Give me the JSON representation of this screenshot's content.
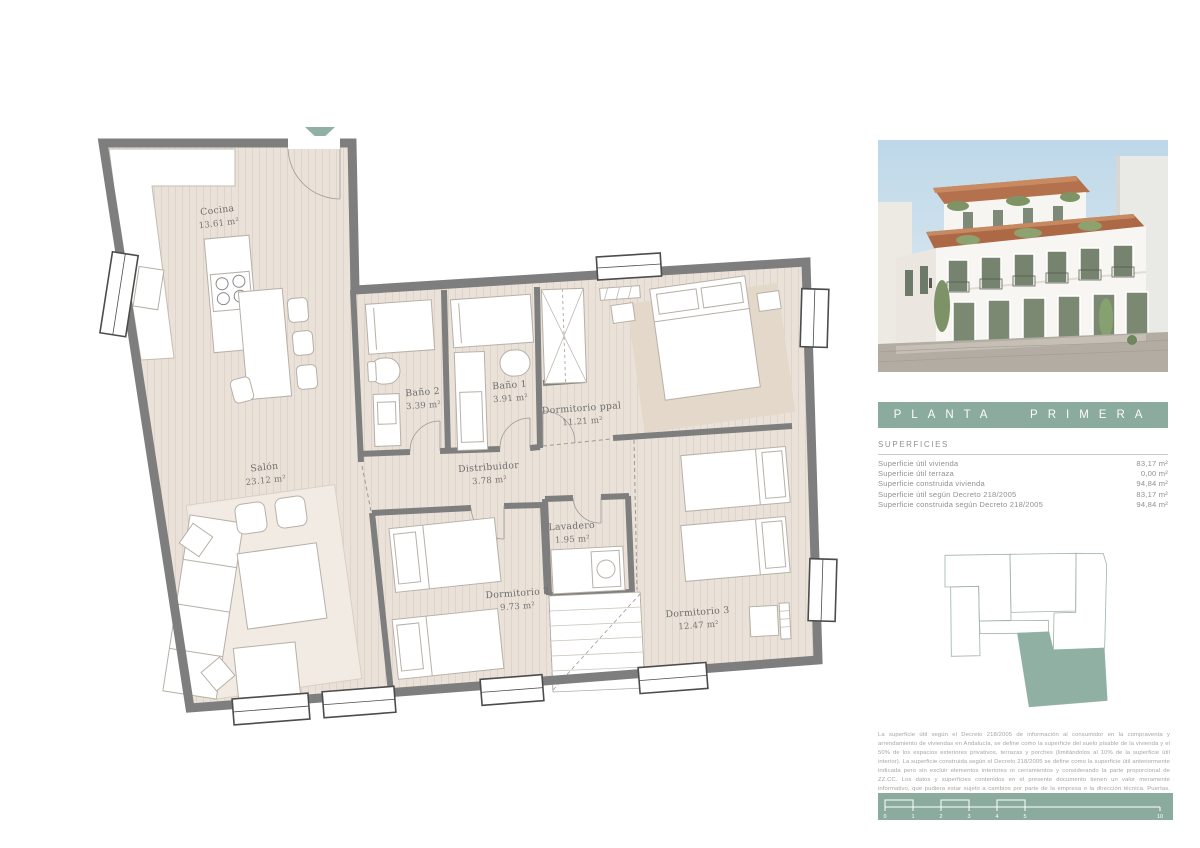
{
  "plan": {
    "rooms": [
      {
        "name": "Cocina",
        "area": "13.61 m²"
      },
      {
        "name": "Baño 2",
        "area": "3.39 m²"
      },
      {
        "name": "Baño 1",
        "area": "3.91 m²"
      },
      {
        "name": "Dormitorio ppal",
        "area": "11.21 m²"
      },
      {
        "name": "Salón",
        "area": "23.12 m²"
      },
      {
        "name": "Distribuidor",
        "area": "3.78 m²"
      },
      {
        "name": "Lavadero",
        "area": "1.95 m²"
      },
      {
        "name": "Dormitorio 2",
        "area": "9.73 m²"
      },
      {
        "name": "Dormitorio 3",
        "area": "12.47 m²"
      }
    ]
  },
  "sidebar": {
    "title": "PLANTA PRIMERA",
    "surfaces": {
      "heading": "SUPERFICIES",
      "rows": [
        {
          "label": "Superficie útil vivienda",
          "value": "83,17 m²"
        },
        {
          "label": "Superficie útil terraza",
          "value": "0,00 m²"
        },
        {
          "label": "Superficie construida vivienda",
          "value": "94,84 m²"
        },
        {
          "label": "Superficie útil según Decreto 218/2005",
          "value": "83,17 m²"
        },
        {
          "label": "Superficie construida según Decreto 218/2005",
          "value": "94,84 m²"
        }
      ]
    },
    "disclaimer": "La superficie útil según el Decreto 218/2005 de información al consumidor en la compraventa y arrendamiento de viviendas en Andalucía, se define como la superficie del suelo pisable de la vivienda y el 50% de los espacios exteriores privativos, terrazas y porches (limitándolos al 10% de la superficie útil interior). La superficie construida según el Decreto 218/2005 se define como la superficie útil anteriormente indicada pero sin excluir elementos interiores ni cerramientos y considerando la parte proporcional de ZZ.CC. Los datos y superficies contenidos en el presente documento tienen un valor meramente informativo, que pudiera estar sujeto a cambios por parte de la empresa o la dirección técnica. Puertas, aperturas, sanitarios o distribución no son vinculantes. Mobiliario, colores, texturas o diseño son únicamente grafismos orientativos, por lo que esta documentación no puede ser considerada como una forma de contrato u obligación.",
    "scale": {
      "labels": [
        "0",
        "1",
        "2",
        "3",
        "4",
        "5",
        "10"
      ]
    }
  },
  "colors": {
    "accent_green": "#8cab9f",
    "keyplan_green": "#8fb0a2",
    "wall_gray": "#7e7e7e",
    "floor_beige": "#eae2d8"
  }
}
